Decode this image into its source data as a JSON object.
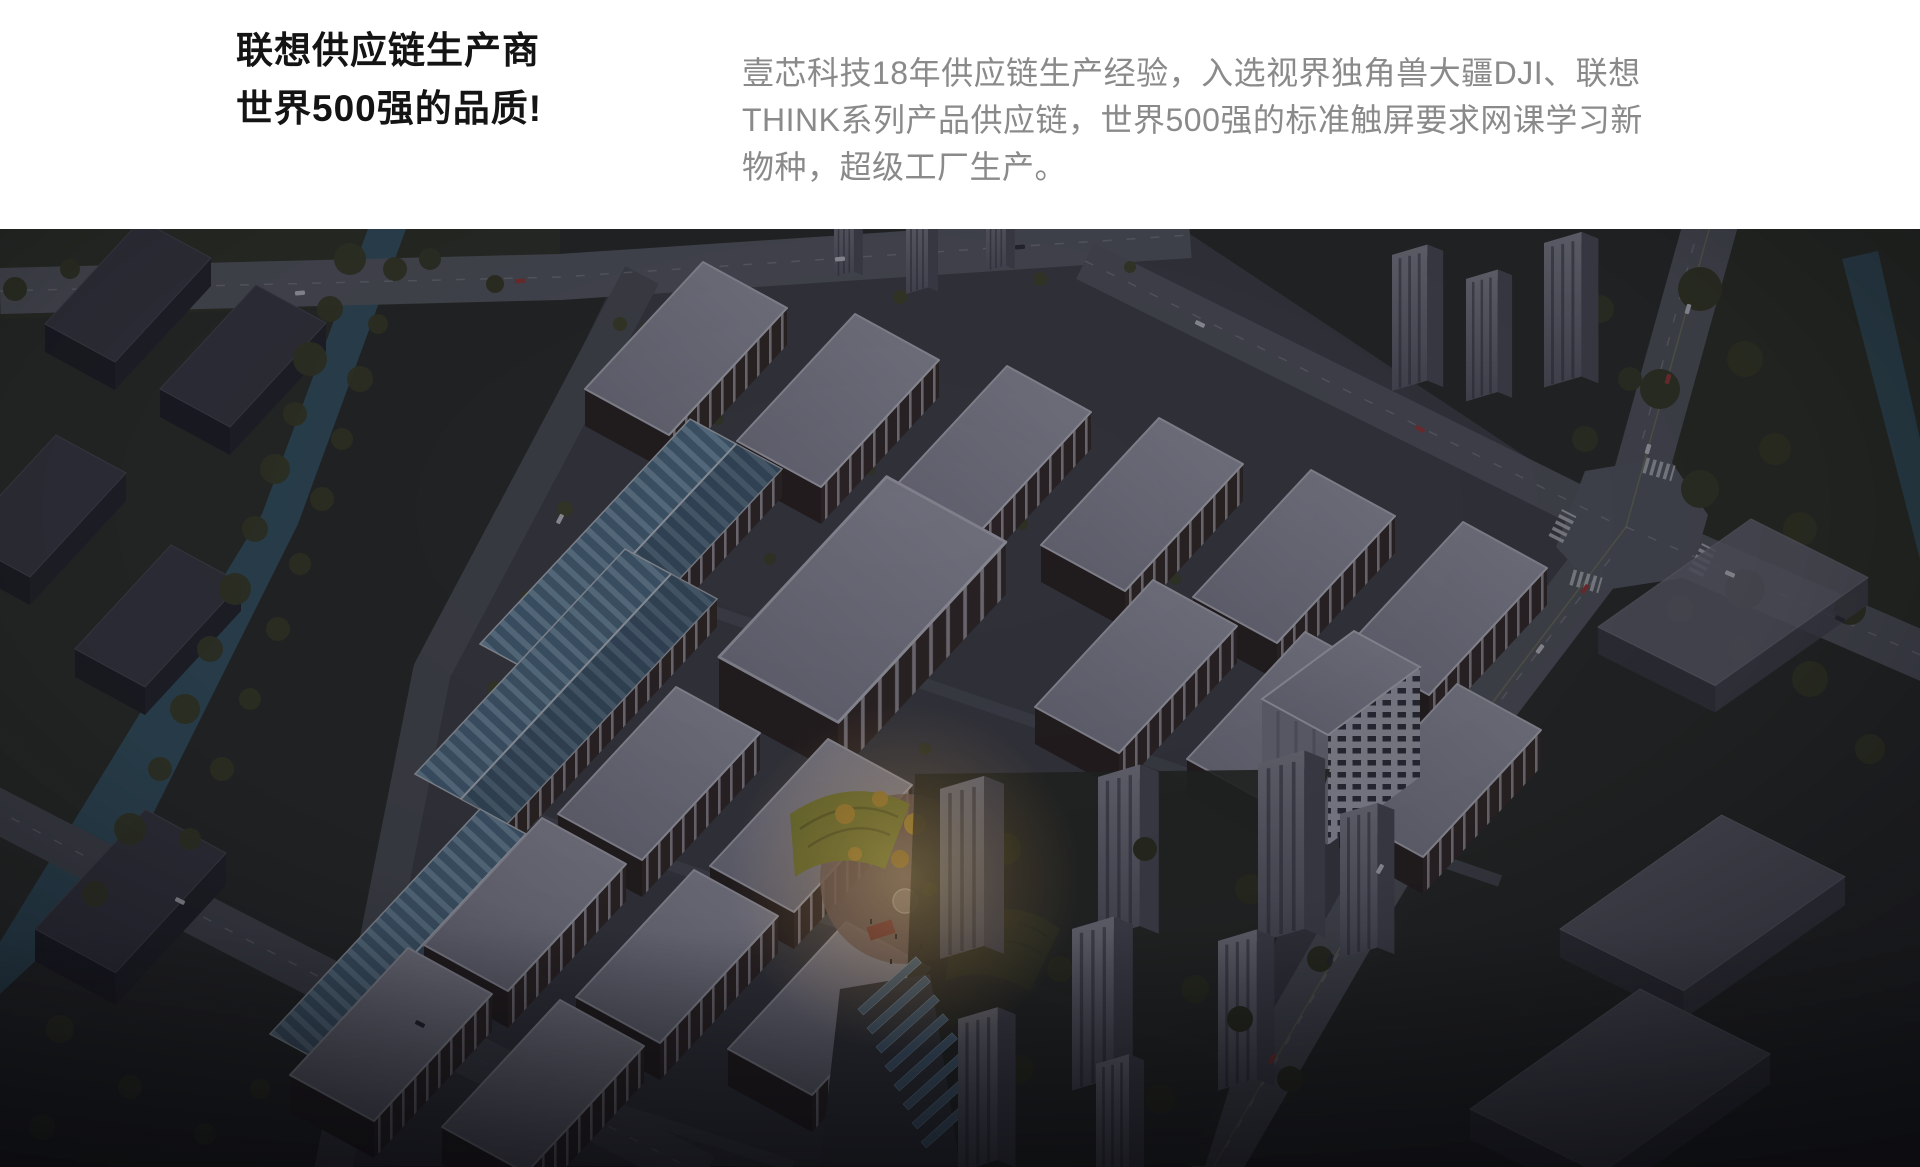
{
  "header": {
    "title_lines": [
      "联想供应链生产商",
      "世界500强的品质!"
    ],
    "description_lines": [
      "壹芯科技18年供应链生产经验，入选视界独角兽大疆DJI、联想",
      "THINK系列产品供应链，世界500强的标准触屏要求网课学习新",
      "物种，超级工厂生产。"
    ],
    "title_color": "#141414",
    "description_color": "#8a8a8a",
    "background": "#ffffff"
  },
  "hero": {
    "palette": {
      "dusk_overlay": "#12141d",
      "factory_roof": "#a8a6b4",
      "facade_brick": "#392b27",
      "road": "#5d5e66",
      "tree_olive": "#3f4226",
      "river_teal": "#3b5f71",
      "warehouse_roof_blue": "#567790",
      "plaza_lawn": "#95993a",
      "plaza_tree_yellow": "#cda231",
      "tower_face": "#90909c"
    }
  }
}
